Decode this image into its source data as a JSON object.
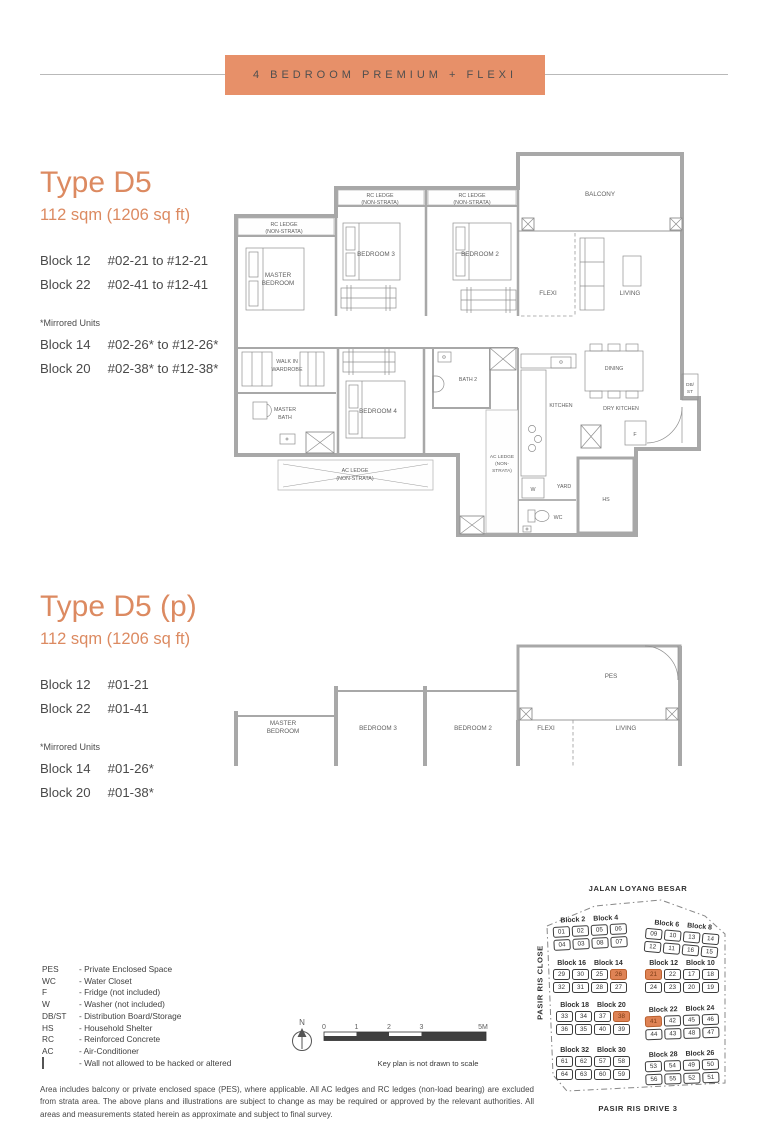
{
  "banner": {
    "title": "4 BEDROOM PREMIUM + FLEXI"
  },
  "colors": {
    "accent": "#DC8A61",
    "banner": "#E79069",
    "keyplan_highlight": "#DF8355"
  },
  "sections": [
    {
      "heading": "Type D5",
      "area": "112 sqm (1206 sq ft)",
      "blocks": [
        {
          "name": "Block 12",
          "units": "#02-21 to #12-21"
        },
        {
          "name": "Block 22",
          "units": "#02-41 to #12-41"
        }
      ],
      "mirrored_note": "*Mirrored Units",
      "mirrored_blocks": [
        {
          "name": "Block 14",
          "units": "#02-26* to #12-26*"
        },
        {
          "name": "Block 20",
          "units": "#02-38* to #12-38*"
        }
      ]
    },
    {
      "heading": "Type D5 (p)",
      "area": "112 sqm (1206 sq ft)",
      "blocks": [
        {
          "name": "Block 12",
          "units": "#01-21"
        },
        {
          "name": "Block 22",
          "units": "#01-41"
        }
      ],
      "mirrored_note": "*Mirrored Units",
      "mirrored_blocks": [
        {
          "name": "Block 14",
          "units": "#01-26*"
        },
        {
          "name": "Block 20",
          "units": "#01-38*"
        }
      ]
    }
  ],
  "plan_labels": {
    "rc_ledge": "RC LEDGE",
    "non_strata": "(NON-STRATA)",
    "balcony": "BALCONY",
    "master_1": "MASTER",
    "master_2": "BEDROOM",
    "bedroom3": "BEDROOM 3",
    "bedroom2": "BEDROOM 2",
    "bedroom4": "BEDROOM 4",
    "flexi": "FLEXI",
    "living": "LIVING",
    "walkin_1": "WALK IN",
    "walkin_2": "WARDROBE",
    "mbath_1": "MASTER",
    "mbath_2": "BATH",
    "bath2": "BATH 2",
    "ac_ledge": "AC LEDGE",
    "ac_non1": "(NON-",
    "ac_non2": "STRATA)",
    "kitchen": "KITCHEN",
    "dry_kitchen": "DRY KITCHEN",
    "dining": "DINING",
    "yard": "YARD",
    "wc": "WC",
    "hs": "HS",
    "w": "W",
    "f": "F",
    "db1": "DB/",
    "db2": "ST",
    "pes": "PES"
  },
  "legend": {
    "items": [
      {
        "abbr": "PES",
        "desc": "- Private Enclosed Space"
      },
      {
        "abbr": "WC",
        "desc": "- Water Closet"
      },
      {
        "abbr": "F",
        "desc": "- Fridge (not included)"
      },
      {
        "abbr": "W",
        "desc": "- Washer (not included)"
      },
      {
        "abbr": "DB/ST",
        "desc": "- Distribution Board/Storage"
      },
      {
        "abbr": "HS",
        "desc": "- Household Shelter"
      },
      {
        "abbr": "RC",
        "desc": "- Reinforced Concrete"
      },
      {
        "abbr": "AC",
        "desc": "- Air-Conditioner"
      }
    ],
    "wall_item": {
      "desc": "- Wall not allowed to be hacked or altered"
    }
  },
  "scalebar": {
    "north": "N",
    "labels": [
      "0",
      "1",
      "2",
      "3",
      "5M"
    ],
    "note": "Key plan is not drawn to scale"
  },
  "keyplan": {
    "top_road": "JALAN LOYANG BESAR",
    "left_road": "PASIR RIS CLOSE",
    "bottom_road": "PASIR RIS DRIVE 3",
    "clusters": [
      {
        "labels": [
          "Block 2",
          "Block 4"
        ],
        "x": 14,
        "y": 38,
        "rot": -3,
        "rows": [
          [
            "01",
            "02",
            "05",
            "06"
          ],
          [
            "04",
            "03",
            "08",
            "07"
          ]
        ],
        "hl": []
      },
      {
        "labels": [
          "Block 6",
          "Block 8"
        ],
        "x": 106,
        "y": 44,
        "rot": 5,
        "rows": [
          [
            "09",
            "10",
            "13",
            "14"
          ],
          [
            "12",
            "11",
            "16",
            "15"
          ]
        ],
        "hl": []
      },
      {
        "labels": [
          "Block 16",
          "Block 14"
        ],
        "x": 14,
        "y": 82,
        "rot": 0,
        "rows": [
          [
            "29",
            "30",
            "25",
            "26"
          ],
          [
            "32",
            "31",
            "28",
            "27"
          ]
        ],
        "hl": [
          "26"
        ]
      },
      {
        "labels": [
          "Block 12",
          "Block 10"
        ],
        "x": 106,
        "y": 82,
        "rot": 0,
        "rows": [
          [
            "21",
            "22",
            "17",
            "18"
          ],
          [
            "24",
            "23",
            "20",
            "19"
          ]
        ],
        "hl": [
          "21"
        ]
      },
      {
        "labels": [
          "Block 18",
          "Block 20"
        ],
        "x": 17,
        "y": 124,
        "rot": 0,
        "rows": [
          [
            "33",
            "34",
            "37",
            "38"
          ],
          [
            "36",
            "35",
            "40",
            "39"
          ]
        ],
        "hl": [
          "38"
        ]
      },
      {
        "labels": [
          "Block 22",
          "Block 24"
        ],
        "x": 106,
        "y": 128,
        "rot": -2,
        "rows": [
          [
            "41",
            "42",
            "45",
            "46"
          ],
          [
            "44",
            "43",
            "48",
            "47"
          ]
        ],
        "hl": [
          "41"
        ]
      },
      {
        "labels": [
          "Block 32",
          "Block 30"
        ],
        "x": 17,
        "y": 169,
        "rot": 0,
        "rows": [
          [
            "61",
            "62",
            "57",
            "58"
          ],
          [
            "64",
            "63",
            "60",
            "59"
          ]
        ],
        "hl": []
      },
      {
        "labels": [
          "Block 28",
          "Block 26"
        ],
        "x": 106,
        "y": 173,
        "rot": -2,
        "rows": [
          [
            "53",
            "54",
            "49",
            "50"
          ],
          [
            "56",
            "55",
            "52",
            "51"
          ]
        ],
        "hl": []
      }
    ]
  },
  "disclaimer": "Area includes balcony or private enclosed space (PES), where applicable. All AC ledges and RC ledges (non-load bearing) are excluded from strata area. The above plans and illustrations are subject to change as may be required or approved by the relevant authorities. All areas and measurements stated herein as approximate and subject to final survey."
}
